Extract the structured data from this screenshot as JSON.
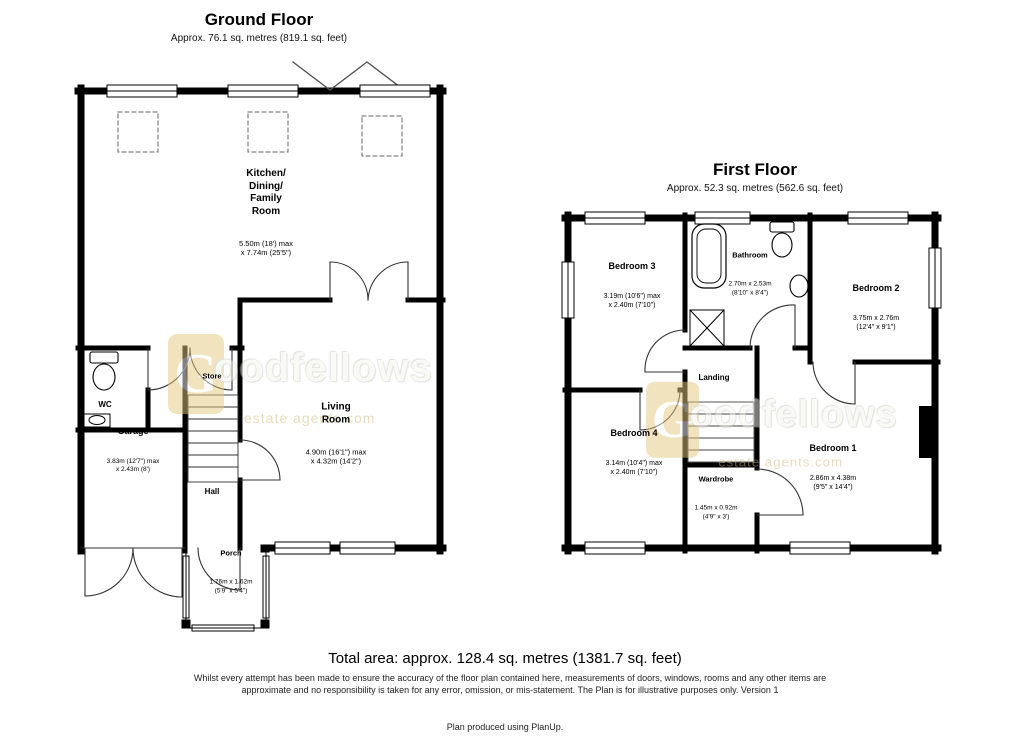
{
  "ground_floor": {
    "title": "Ground Floor",
    "subtitle": "Approx. 76.1 sq. metres (819.1 sq. feet)",
    "rooms": {
      "kitchen": {
        "name": "Kitchen/\nDining/\nFamily\nRoom",
        "dims": "5.50m (18') max\nx 7.74m (25'5\")"
      },
      "living": {
        "name": "Living\nRoom",
        "dims": "4.90m (16'1\") max\nx 4.32m (14'2\")"
      },
      "wc": {
        "name": "WC"
      },
      "garage": {
        "name": "Garage",
        "dims": "3.83m (12'7\") max\nx 2.43m (8')"
      },
      "store": {
        "name": "Store"
      },
      "hall": {
        "name": "Hall"
      },
      "porch": {
        "name": "Porch",
        "dims": "1.76m x 1.62m\n(5'9\" x 5'4\")"
      }
    }
  },
  "first_floor": {
    "title": "First Floor",
    "subtitle": "Approx. 52.3 sq. metres (562.6 sq. feet)",
    "rooms": {
      "bedroom3": {
        "name": "Bedroom 3",
        "dims": "3.19m (10'6\") max\nx 2.40m (7'10\")"
      },
      "bathroom": {
        "name": "Bathroom",
        "dims": "2.70m x 2.53m\n(8'10\" x 8'4\")"
      },
      "bedroom2": {
        "name": "Bedroom 2",
        "dims": "3.75m x 2.76m\n(12'4\" x 9'1\")"
      },
      "landing": {
        "name": "Landing"
      },
      "bedroom4": {
        "name": "Bedroom 4",
        "dims": "3.14m (10'4\") max\nx 2.40m (7'10\")"
      },
      "wardrobe": {
        "name": "Wardrobe",
        "dims": "1.45m x 0.92m\n(4'9\" x 3')"
      },
      "bedroom1": {
        "name": "Bedroom 1",
        "dims": "2.86m x 4.38m\n(9'5\" x 14'4\")"
      }
    }
  },
  "watermark": {
    "initial": "G",
    "rest": "oodfellows",
    "tagline": "estate agents.com",
    "tile_color": "#e3c87f"
  },
  "footer": {
    "total_area": "Total area: approx. 128.4 sq. metres (1381.7 sq. feet)",
    "disclaimer_line1": "Whilst every attempt has been made to ensure the accuracy of the floor plan contained here, measurements of doors, windows, rooms and any other items are",
    "disclaimer_line2": "approximate and no responsibility is taken for any error, omission, or mis-statement. The Plan is for illustrative purposes only. Version 1",
    "credit": "Plan produced using PlanUp."
  }
}
